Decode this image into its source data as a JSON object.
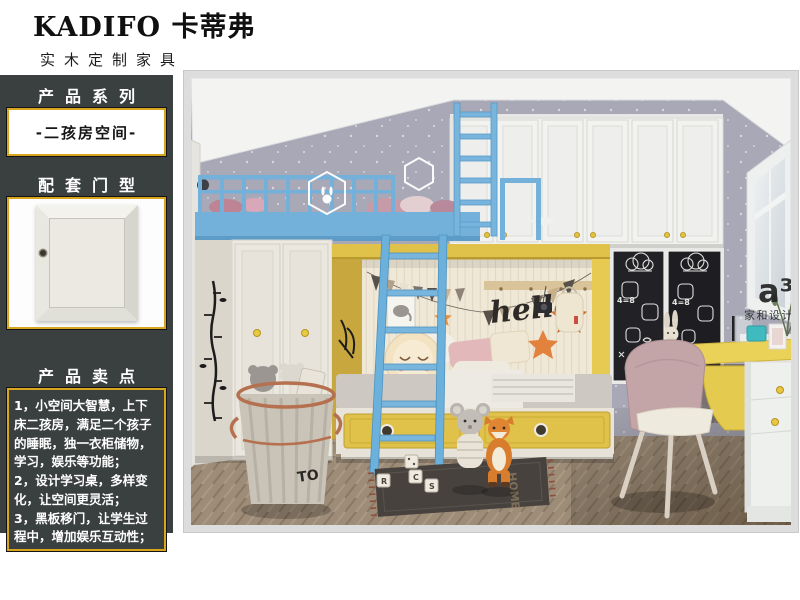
{
  "brand": {
    "title": "KADIFO 卡蒂弗",
    "subtitle": "实木定制家具"
  },
  "sidebar": {
    "series_header": "产品系列",
    "series_value": "-二孩房空间-",
    "door_header": "配套门型",
    "points_header": "产品卖点",
    "points": [
      "1，小空间大智慧，上下床二孩房，满足二个孩子的睡眠，独一衣柜储物，学习，娱乐等功能；",
      "2，设计学习桌，多样变化，让空间更灵活；",
      "3，黑板移门，让学生过程中，增加娱乐互动性；"
    ]
  },
  "room": {
    "wall_text": "hello",
    "watermark": "a³",
    "watermark_sub": "家和设计",
    "basket_label": "TO",
    "rug_word": "HOME",
    "chalk": {
      "equation": "4=8",
      "numbers": "123"
    },
    "cube_letters": [
      "R",
      "C",
      "S"
    ]
  },
  "colors": {
    "sidebar_bg": "#3a3f40",
    "gold_border": "#d8a51f",
    "bed_blue": "#74b1da",
    "accent_yellow": "#e0c149",
    "wall_gray": "#a8a8b6",
    "chalkboard": "#222226",
    "chair_pink": "#c3a4a7",
    "floor_wood": "#9d8c78"
  }
}
